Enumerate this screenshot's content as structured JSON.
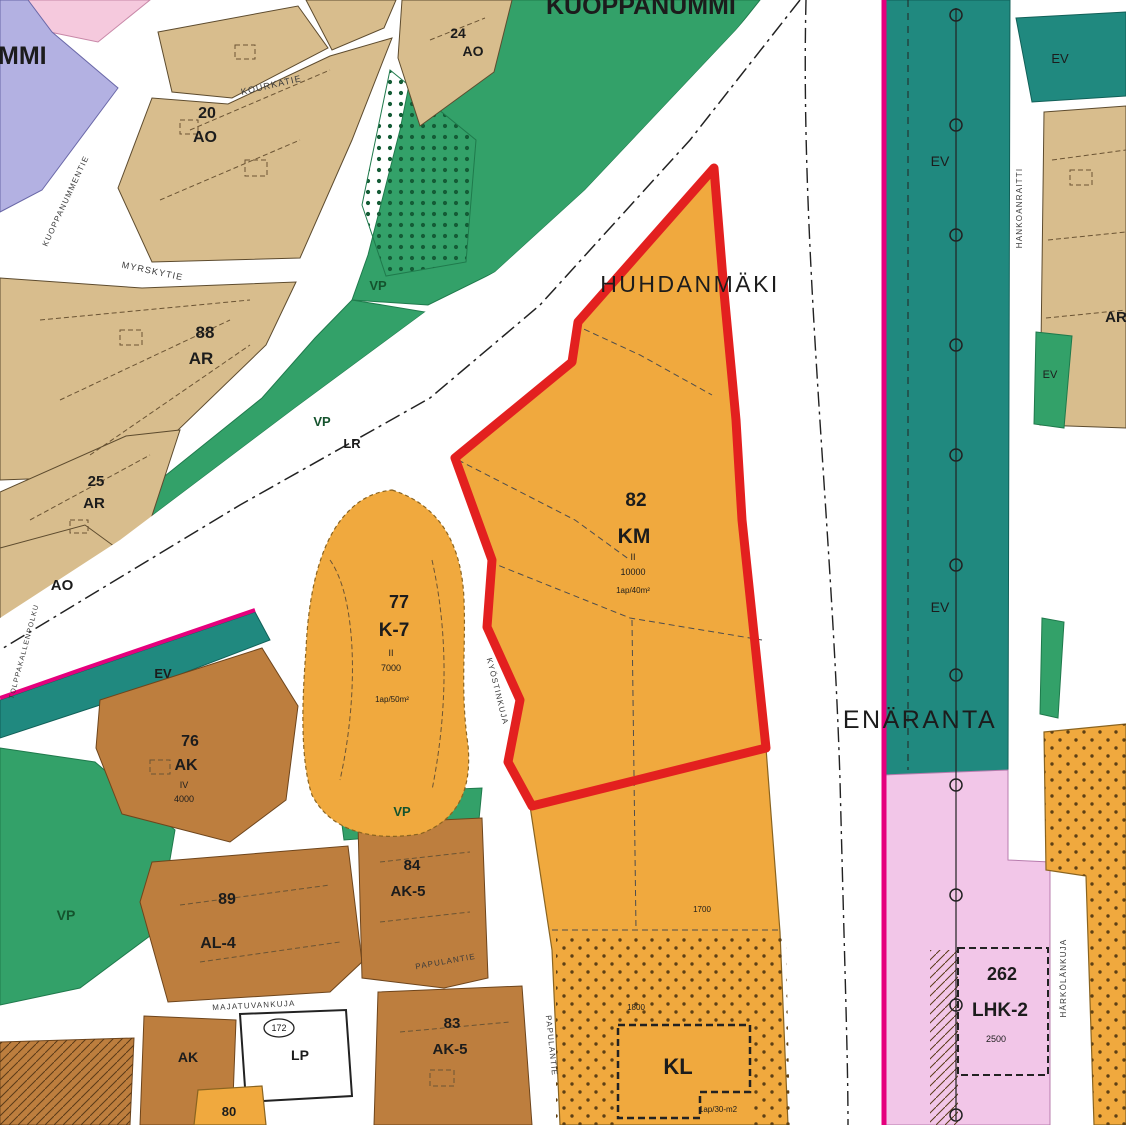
{
  "places": {
    "kuoppanummi": "KUOPPANUMMI",
    "huhdanmaki": "HUHDANMÄKI",
    "enaranta": "ENÄRANTA",
    "mmi_partial": "MMI"
  },
  "codes": {
    "vp": "VP",
    "ev": "EV",
    "lr": "LR"
  },
  "zones": {
    "z20": {
      "number": "20",
      "code": "AO"
    },
    "z24": {
      "number": "24",
      "code": "AO"
    },
    "z88": {
      "number": "88",
      "code": "AR"
    },
    "z25": {
      "number": "25",
      "code": "AR"
    },
    "ao": {
      "code": "AO"
    },
    "z76": {
      "number": "76",
      "code": "AK",
      "storeys": "IV",
      "area": "4000"
    },
    "z89": {
      "number": "89",
      "code": "AL-4"
    },
    "z84": {
      "number": "84",
      "code": "AK-5"
    },
    "z83": {
      "number": "83",
      "code": "AK-5"
    },
    "ak": {
      "code": "AK"
    },
    "lp": {
      "code": "LP",
      "badge": "172"
    },
    "z80": {
      "number": "80"
    },
    "z77": {
      "number": "77",
      "code": "K-7",
      "storeys": "II",
      "area": "7000",
      "parking": "1ap/50m²"
    },
    "z82": {
      "number": "82",
      "code": "KM",
      "storeys": "II",
      "area": "10000",
      "parking": "1ap/40m²"
    },
    "kl": {
      "code": "KL",
      "area": "1800",
      "parking": "1ap/30-m2",
      "note": "1700"
    },
    "z262": {
      "number": "262",
      "code": "LHK-2",
      "area": "2500"
    },
    "ar_right": {
      "code": "AR"
    }
  },
  "streets": {
    "kourkatie": "KOURKATIE",
    "kuoppanummentie": "KUOPPANUMMENTIE",
    "myrskytie": "MYRSKYTIE",
    "tolppakallenpolku": "TOLPPAKALLENPOLKU",
    "kyostinkuja": "KYÖSTINKUJA",
    "majatuvankuja": "MAJATUVANKUJA",
    "papulantie": "PAPULANTIE",
    "hankoanraitti": "HANKOANRAITTI",
    "harkolankuja": "HÄRKÖLÄNKUJA"
  },
  "colors": {
    "park_green": "#33a169",
    "forest_teal": "#20897f",
    "residential_tan": "#d8bd8d",
    "apartment_brown": "#bd7e3e",
    "commercial_orange": "#f0a93e",
    "reserve_purple": "#b3b1e2",
    "lhk_pink": "#f2c6e8",
    "top_pink": "#f5c9dd",
    "highlight_red": "#e3201f",
    "boundary_magenta": "#e5007d",
    "road_white": "#ffffff",
    "line_dark": "#3c3c3c"
  }
}
